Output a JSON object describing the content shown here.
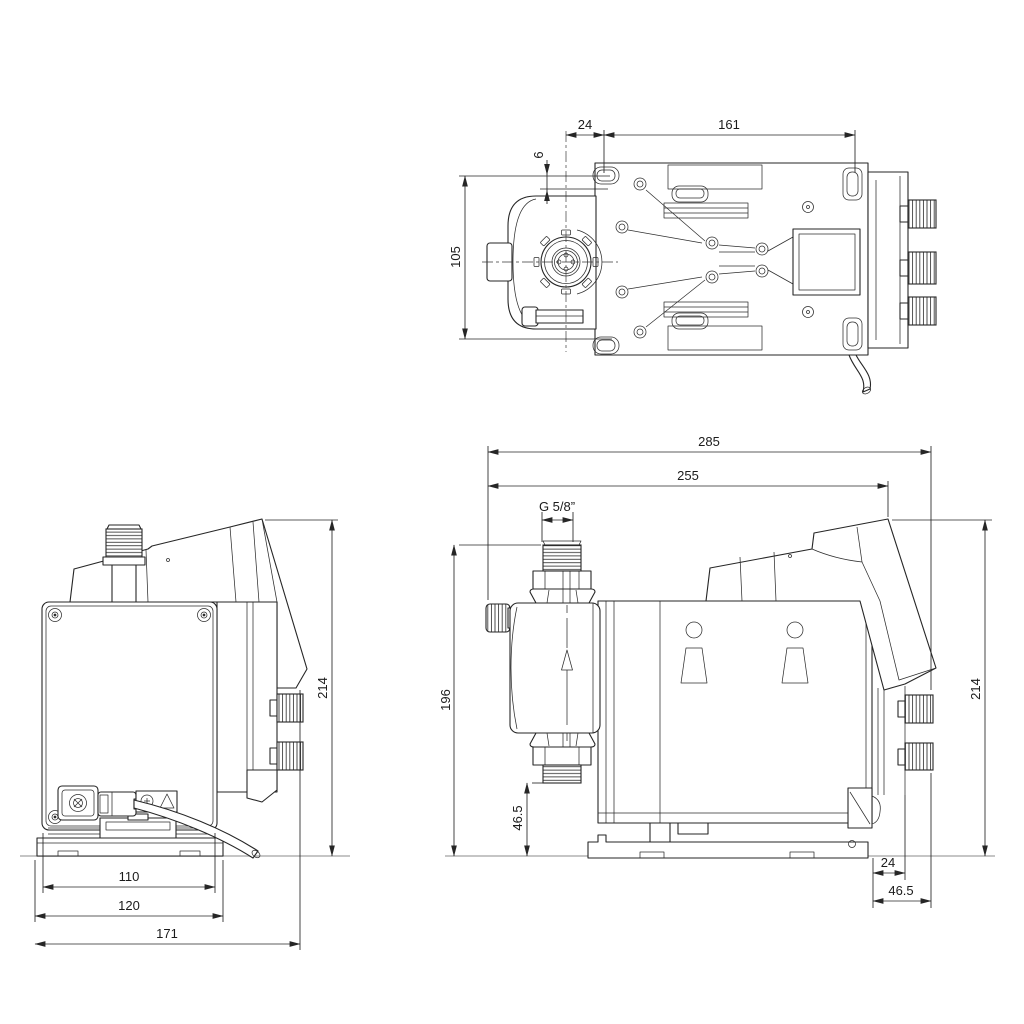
{
  "colors": {
    "background": "#ffffff",
    "line": "#262626",
    "dimension_text": "#1b1b1b",
    "ground_line": "#bdbdbd"
  },
  "views": {
    "top": {
      "dims": {
        "valve_to_hole": "24",
        "hole_spacing": "161",
        "hole_to_edge": "6",
        "width": "105"
      }
    },
    "rear": {
      "dims": {
        "plate_width": "110",
        "base_width": "120",
        "depth": "171",
        "height": "214"
      }
    },
    "side": {
      "dims": {
        "total_length": "285",
        "body_length": "255",
        "connection_thread": "G 5/8”",
        "head_top_height": "196",
        "suction_valve_height": "46.5",
        "height": "214",
        "knob_offset": "24",
        "knob_overhang": "46.5"
      }
    }
  }
}
